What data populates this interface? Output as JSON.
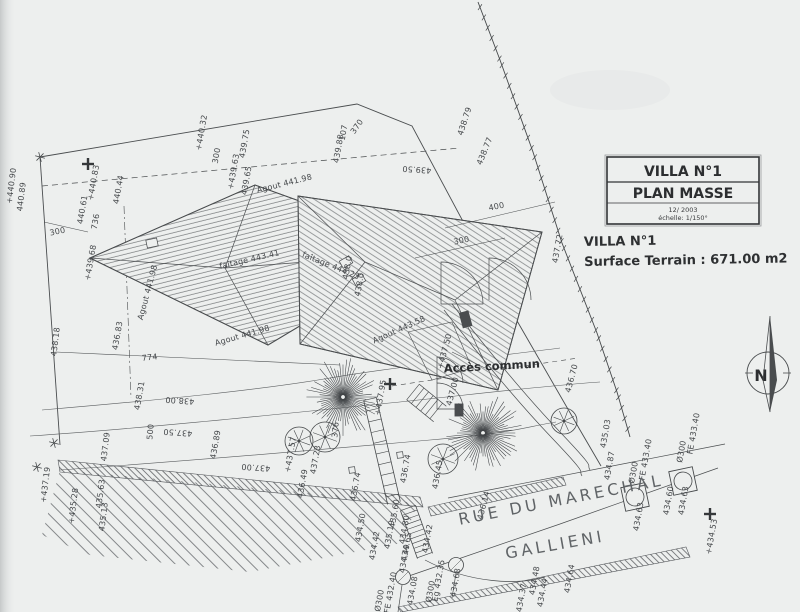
{
  "title_block": {
    "line1": "VILLA N°1",
    "line2": "PLAN MASSE",
    "line3": "12/ 2003",
    "line4": "échelle: 1/150°"
  },
  "info": {
    "villa": "VILLA N°1",
    "surface": "Surface Terrain : 671.00 m2"
  },
  "compass": {
    "label": "N"
  },
  "street": {
    "line1": "RUE DU MARECHAL",
    "line2": "GALLIENI"
  },
  "access_label": "Accès commun",
  "colors": {
    "paper": "#edefee",
    "ink": "#45484a",
    "ink_dark": "#2e3032",
    "ink_light": "#63666a"
  },
  "plan": {
    "labels": [
      {
        "t": "+440.90",
        "x": 14,
        "y": 186,
        "r": -83
      },
      {
        "t": "440.89",
        "x": 24,
        "y": 197,
        "r": -83
      },
      {
        "t": "+440.83",
        "x": 96,
        "y": 183,
        "r": -80
      },
      {
        "t": "440.61",
        "x": 85,
        "y": 210,
        "r": -80
      },
      {
        "t": "736",
        "x": 98,
        "y": 222,
        "r": -80
      },
      {
        "t": "300",
        "x": 58,
        "y": 234,
        "r": -12
      },
      {
        "t": "440.44",
        "x": 121,
        "y": 190,
        "r": -80
      },
      {
        "t": "+439.68",
        "x": 93,
        "y": 263,
        "r": -80
      },
      {
        "t": "438.18",
        "x": 58,
        "y": 342,
        "r": -83
      },
      {
        "t": "+440.32",
        "x": 204,
        "y": 133,
        "r": -80
      },
      {
        "t": "300",
        "x": 219,
        "y": 156,
        "r": -80
      },
      {
        "t": "439.75",
        "x": 247,
        "y": 144,
        "r": -80
      },
      {
        "t": "+439.63",
        "x": 236,
        "y": 172,
        "r": -80
      },
      {
        "t": "439.65",
        "x": 249,
        "y": 181,
        "r": -80
      },
      {
        "t": "107",
        "x": 346,
        "y": 133,
        "r": -80
      },
      {
        "t": "439.88",
        "x": 341,
        "y": 149,
        "r": -80
      },
      {
        "t": "370",
        "x": 359,
        "y": 128,
        "r": -55
      },
      {
        "t": "438.79",
        "x": 467,
        "y": 122,
        "r": -72
      },
      {
        "t": "438.77",
        "x": 487,
        "y": 152,
        "r": -68
      },
      {
        "t": "439.50",
        "x": 417,
        "y": 167,
        "r": 184
      },
      {
        "t": "400",
        "x": 497,
        "y": 209,
        "r": -12
      },
      {
        "t": "300",
        "x": 462,
        "y": 243,
        "r": -12
      },
      {
        "t": "437.72",
        "x": 560,
        "y": 249,
        "r": -80
      },
      {
        "t": "436.70",
        "x": 574,
        "y": 379,
        "r": -75
      },
      {
        "t": "774",
        "x": 150,
        "y": 360,
        "r": -6
      },
      {
        "t": "436.83",
        "x": 120,
        "y": 336,
        "r": -80
      },
      {
        "t": "438.00",
        "x": 180,
        "y": 398,
        "r": 184
      },
      {
        "t": "+437.95",
        "x": 383,
        "y": 398,
        "r": -80
      },
      {
        "t": "438.31",
        "x": 142,
        "y": 396,
        "r": -80
      },
      {
        "t": "437.50",
        "x": 178,
        "y": 430,
        "r": 184
      },
      {
        "t": "437.09",
        "x": 108,
        "y": 447,
        "r": -83
      },
      {
        "t": "437.00",
        "x": 256,
        "y": 465,
        "r": 184
      },
      {
        "t": "500",
        "x": 153,
        "y": 432,
        "r": -85
      },
      {
        "t": "+437.19",
        "x": 48,
        "y": 485,
        "r": -83
      },
      {
        "t": "435.63",
        "x": 103,
        "y": 494,
        "r": -83
      },
      {
        "t": "+435.28",
        "x": 76,
        "y": 506,
        "r": -83
      },
      {
        "t": "435.13",
        "x": 106,
        "y": 517,
        "r": -83
      },
      {
        "t": "436.89",
        "x": 218,
        "y": 445,
        "r": -80
      },
      {
        "t": "+437.57",
        "x": 293,
        "y": 455,
        "r": -80
      },
      {
        "t": "436.49",
        "x": 305,
        "y": 484,
        "r": -80
      },
      {
        "t": "437.23",
        "x": 318,
        "y": 460,
        "r": -80
      },
      {
        "t": "436.74",
        "x": 358,
        "y": 487,
        "r": -80
      },
      {
        "t": "436.74",
        "x": 408,
        "y": 469,
        "r": -80
      },
      {
        "t": "376",
        "x": 338,
        "y": 430,
        "r": -85
      },
      {
        "t": "436.45",
        "x": 440,
        "y": 475,
        "r": -80
      },
      {
        "t": "436.14",
        "x": 486,
        "y": 506,
        "r": -75
      },
      {
        "t": "435.60",
        "x": 397,
        "y": 514,
        "r": -80
      },
      {
        "t": "434.80",
        "x": 407,
        "y": 530,
        "r": -80
      },
      {
        "t": "435.19",
        "x": 392,
        "y": 535,
        "r": -80
      },
      {
        "t": "434.65",
        "x": 409,
        "y": 547,
        "r": -80
      },
      {
        "t": "434.49",
        "x": 407,
        "y": 559,
        "r": -80
      },
      {
        "t": "434.42",
        "x": 430,
        "y": 539,
        "r": -80
      },
      {
        "t": "434.50",
        "x": 363,
        "y": 528,
        "r": -80
      },
      {
        "t": "434.42",
        "x": 377,
        "y": 546,
        "r": -80
      },
      {
        "t": "FE 432.40",
        "x": 393,
        "y": 593,
        "r": -80
      },
      {
        "t": "Ø300",
        "x": 382,
        "y": 601,
        "r": -80
      },
      {
        "t": "Eg 432.35",
        "x": 441,
        "y": 581,
        "r": -80
      },
      {
        "t": "Ø300",
        "x": 433,
        "y": 592,
        "r": -80
      },
      {
        "t": "434.08",
        "x": 415,
        "y": 591,
        "r": -80
      },
      {
        "t": "434.68",
        "x": 458,
        "y": 583,
        "r": -80
      },
      {
        "t": "434.48",
        "x": 537,
        "y": 581,
        "r": -80
      },
      {
        "t": "434.44",
        "x": 545,
        "y": 593,
        "r": -80
      },
      {
        "t": "434.37",
        "x": 524,
        "y": 598,
        "r": -80
      },
      {
        "t": "434.64",
        "x": 572,
        "y": 579,
        "r": -80
      },
      {
        "t": "FE 433.40",
        "x": 648,
        "y": 460,
        "r": -80
      },
      {
        "t": "Ø300",
        "x": 636,
        "y": 473,
        "r": -80
      },
      {
        "t": "FE 433.40",
        "x": 696,
        "y": 434,
        "r": -80
      },
      {
        "t": "Ø300",
        "x": 684,
        "y": 452,
        "r": -80
      },
      {
        "t": "434.60",
        "x": 671,
        "y": 501,
        "r": -80
      },
      {
        "t": "434.63",
        "x": 686,
        "y": 501,
        "r": -80
      },
      {
        "t": "434.63",
        "x": 641,
        "y": 517,
        "r": -80
      },
      {
        "t": "+434.53",
        "x": 714,
        "y": 537,
        "r": -80
      },
      {
        "t": "435.03",
        "x": 608,
        "y": 434,
        "r": -80
      },
      {
        "t": "434.87",
        "x": 612,
        "y": 466,
        "r": -80
      },
      {
        "t": "faîtage 443.41",
        "x": 250,
        "y": 262,
        "r": -13,
        "s": 7
      },
      {
        "t": "faîtage 444.23",
        "x": 330,
        "y": 268,
        "r": 22,
        "s": 7
      },
      {
        "t": "Agout 441.98",
        "x": 285,
        "y": 186,
        "r": -14,
        "s": 7
      },
      {
        "t": "Agout 441.98",
        "x": 150,
        "y": 293,
        "r": -75,
        "s": 7
      },
      {
        "t": "Agout 441.98",
        "x": 243,
        "y": 338,
        "r": -16,
        "s": 7
      },
      {
        "t": "Agout 443.58",
        "x": 400,
        "y": 332,
        "r": -24,
        "s": 7
      },
      {
        "t": "438.0",
        "x": 350,
        "y": 268,
        "r": -80,
        "s": 6.5
      },
      {
        "t": "438.0",
        "x": 362,
        "y": 285,
        "r": -80,
        "s": 6.5
      },
      {
        "t": "+437.50",
        "x": 447,
        "y": 352,
        "r": -75
      },
      {
        "t": "437.00",
        "x": 455,
        "y": 392,
        "r": -75
      }
    ],
    "fences": [
      {
        "pts": [
          [
            478,
            2
          ],
          [
            500,
            60
          ],
          [
            533,
            152
          ],
          [
            562,
            243
          ],
          [
            597,
            333
          ],
          [
            617,
            392
          ],
          [
            630,
            437
          ]
        ],
        "gap": 11,
        "tick": 7
      }
    ],
    "ladders": [
      {
        "x1": 370,
        "y1": 399,
        "x2": 394,
        "y2": 503,
        "w": 13,
        "step": 11
      },
      {
        "x1": 408,
        "y1": 508,
        "x2": 425,
        "y2": 556,
        "w": 16,
        "step": 5
      },
      {
        "x1": 413,
        "y1": 392,
        "x2": 440,
        "y2": 414,
        "w": 20,
        "step": 6
      }
    ],
    "bands": [
      {
        "pts": [
          [
            58,
            460
          ],
          [
            420,
            497
          ],
          [
            423,
            507
          ],
          [
            60,
            472
          ]
        ]
      },
      {
        "pts": [
          [
            428,
            507
          ],
          [
            563,
            477
          ],
          [
            566,
            485
          ],
          [
            431,
            516
          ]
        ]
      },
      {
        "pts": [
          [
            398,
            607
          ],
          [
            686,
            547
          ],
          [
            690,
            557
          ],
          [
            401,
            612
          ]
        ]
      },
      {
        "pts": [
          [
            60,
            470
          ],
          [
            418,
            503
          ],
          [
            402,
            543
          ],
          [
            250,
            572
          ],
          [
            90,
            555
          ],
          [
            42,
            535
          ]
        ],
        "wide": true
      }
    ],
    "trees": {
      "large": [
        {
          "x": 343,
          "y": 397,
          "r": 40
        },
        {
          "x": 483,
          "y": 433,
          "r": 40
        }
      ],
      "small": [
        {
          "x": 299,
          "y": 441,
          "r": 14
        },
        {
          "x": 325,
          "y": 437,
          "r": 15
        },
        {
          "x": 443,
          "y": 459,
          "r": 15
        },
        {
          "x": 564,
          "y": 421,
          "r": 13
        }
      ]
    },
    "manholes": {
      "squares": [
        {
          "x": 635,
          "y": 497
        },
        {
          "x": 683,
          "y": 481
        }
      ],
      "circles": [
        {
          "x": 403,
          "y": 577
        },
        {
          "x": 456,
          "y": 565
        }
      ]
    },
    "crosses": [
      {
        "x": 88,
        "y": 164
      },
      {
        "x": 390,
        "y": 384
      },
      {
        "x": 710,
        "y": 514
      }
    ],
    "xmarks": [
      {
        "x": 40,
        "y": 157
      },
      {
        "x": 54,
        "y": 443
      },
      {
        "x": 37,
        "y": 467
      }
    ],
    "sqmarkers": [
      {
        "x": 352,
        "y": 470
      },
      {
        "x": 400,
        "y": 455
      }
    ],
    "chimneys": [
      {
        "x": 346,
        "y": 262,
        "r": -30
      },
      {
        "x": 359,
        "y": 280,
        "r": -30
      },
      {
        "x": 152,
        "y": 243,
        "r": -12
      }
    ]
  }
}
